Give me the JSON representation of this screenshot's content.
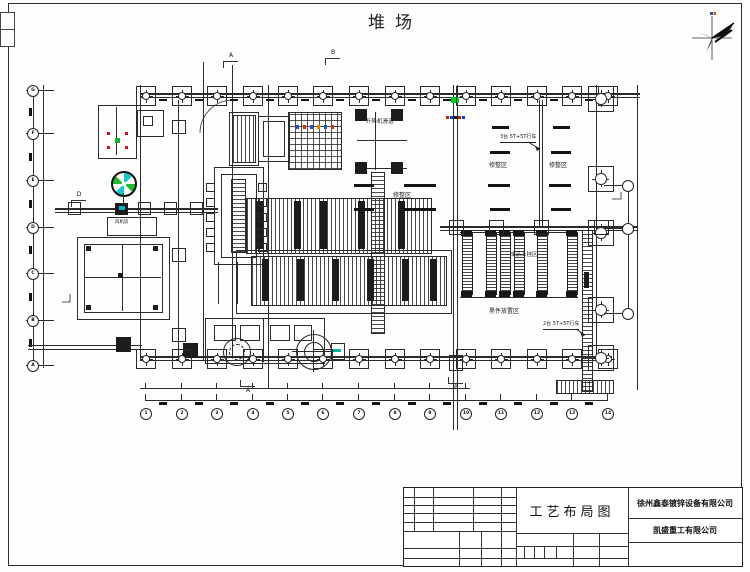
{
  "page": {
    "title": "堆场"
  },
  "titleblock": {
    "drawing_name": "工艺布局图",
    "company1": "徐州鑫泰镀锌设备有限公司",
    "company2": "凯盛重工有限公司"
  },
  "labels": [
    {
      "text": "升降机滑道",
      "x": 366,
      "y": 119,
      "fs": 5.5,
      "u": false
    },
    {
      "text": "修整区",
      "x": 393,
      "y": 193,
      "fs": 6,
      "u": false
    },
    {
      "text": "修整区",
      "x": 489,
      "y": 163,
      "fs": 6,
      "u": false
    },
    {
      "text": "修整区",
      "x": 549,
      "y": 163,
      "fs": 6,
      "u": false
    },
    {
      "text": "3台 5T+5T行车",
      "x": 500,
      "y": 135,
      "fs": 5,
      "u": true
    },
    {
      "text": "2台 5T+5T行车",
      "x": 543,
      "y": 322,
      "fs": 5,
      "u": true
    },
    {
      "text": "成品上挂区",
      "x": 510,
      "y": 252,
      "fs": 5.5,
      "u": false
    },
    {
      "text": "黑件放置区",
      "x": 489,
      "y": 309,
      "fs": 6,
      "u": false
    },
    {
      "text": "风机房",
      "x": 115,
      "y": 221,
      "fs": 4.5,
      "u": false
    }
  ],
  "sections": [
    {
      "t": "A",
      "x": 224,
      "y": 52,
      "d": 1
    },
    {
      "t": "B",
      "x": 326,
      "y": 49,
      "d": 1
    },
    {
      "t": "A",
      "x": 241,
      "y": 386,
      "d": 0
    },
    {
      "t": "B",
      "x": 449,
      "y": 383,
      "d": 0
    },
    {
      "t": "D",
      "x": 72,
      "y": 191,
      "d": 1
    }
  ],
  "grid": {
    "bottom_labels": [
      "1",
      "2",
      "3",
      "4",
      "5",
      "6",
      "7",
      "8",
      "9",
      "10",
      "11",
      "12",
      "13",
      "14"
    ],
    "left_labels": [
      "G",
      "F",
      "E",
      "D",
      "C",
      "B",
      "A"
    ]
  },
  "structure": {
    "col_xs": [
      145,
      181,
      216,
      252,
      287,
      322,
      358,
      394,
      429,
      465,
      500,
      536,
      571,
      607
    ],
    "left_ys": [
      90,
      133,
      180,
      227,
      273,
      320,
      365
    ],
    "right_sq_ys": [
      86,
      166,
      220,
      297,
      345
    ],
    "right_bub_ys": [
      185,
      228,
      313
    ],
    "rack_xs": [
      462,
      486,
      500,
      514,
      537,
      567
    ],
    "tank_bars": [
      [
        256,
        201,
        48
      ],
      [
        294,
        201,
        48
      ],
      [
        320,
        201,
        48
      ],
      [
        358,
        201,
        48
      ],
      [
        398,
        201,
        48
      ],
      [
        262,
        259,
        42
      ],
      [
        297,
        259,
        42
      ],
      [
        332,
        259,
        42
      ],
      [
        367,
        259,
        42
      ],
      [
        402,
        259,
        42
      ],
      [
        430,
        259,
        42
      ]
    ],
    "dashes": [
      [
        492,
        126,
        17
      ],
      [
        553,
        126,
        17
      ],
      [
        490,
        151,
        20
      ],
      [
        551,
        151,
        20
      ],
      [
        488,
        184,
        22
      ],
      [
        549,
        184,
        22
      ],
      [
        490,
        208,
        20
      ],
      [
        551,
        208,
        20
      ],
      [
        354,
        184,
        20
      ],
      [
        404,
        184,
        32
      ],
      [
        354,
        208,
        20
      ],
      [
        404,
        208,
        32
      ]
    ],
    "elev_sq": [
      [
        355,
        109
      ],
      [
        391,
        109
      ],
      [
        355,
        162
      ],
      [
        391,
        162
      ]
    ],
    "wall_sq_xs": [
      455,
      495,
      540,
      600
    ],
    "conv_sq_xs": [
      68,
      138,
      164,
      190
    ],
    "kettle_tick_xs": [
      206,
      258
    ],
    "kettle_tick_ys": [
      183,
      198,
      213,
      228,
      243
    ],
    "rail_block_ys": [
      120,
      248,
      328
    ],
    "room_dots": [
      [
        86,
        246
      ],
      [
        153,
        246
      ],
      [
        86,
        305
      ],
      [
        153,
        305
      ],
      [
        118,
        273
      ]
    ],
    "lines": [
      [
        140,
        93,
        500,
        2
      ],
      [
        140,
        97,
        500,
        1
      ],
      [
        140,
        356,
        472,
        2
      ],
      [
        140,
        360,
        472,
        1
      ],
      [
        440,
        226,
        197,
        2
      ],
      [
        440,
        230,
        197,
        1
      ],
      [
        637,
        85,
        1,
        305
      ],
      [
        140,
        85,
        1,
        275
      ],
      [
        596,
        85,
        1,
        272
      ],
      [
        178,
        100,
        1,
        256
      ],
      [
        203,
        62,
        1,
        298
      ],
      [
        232,
        65,
        1,
        293
      ],
      [
        268,
        85,
        1,
        303
      ],
      [
        453,
        85,
        1,
        345
      ],
      [
        457,
        85,
        1,
        345
      ],
      [
        539,
        100,
        1,
        128
      ],
      [
        542,
        100,
        1,
        128
      ],
      [
        55,
        208,
        163,
        2
      ],
      [
        55,
        212,
        163,
        1
      ],
      [
        28,
        345,
        114,
        1
      ],
      [
        28,
        349,
        114,
        1
      ],
      [
        140,
        388,
        330,
        1
      ],
      [
        145,
        400,
        462,
        1
      ],
      [
        33,
        88,
        1,
        277
      ],
      [
        43,
        85,
        1,
        283
      ],
      [
        628,
        180,
        1,
        140
      ],
      [
        218,
        262,
        1,
        42
      ],
      [
        237,
        262,
        1,
        42
      ],
      [
        375,
        112,
        1,
        58
      ],
      [
        357,
        140,
        50,
        1
      ],
      [
        357,
        168,
        50,
        1
      ],
      [
        460,
        232,
        118,
        1
      ],
      [
        460,
        297,
        118,
        1
      ],
      [
        116,
        107,
        1,
        48
      ],
      [
        122,
        244,
        1,
        67
      ],
      [
        84,
        277,
        77,
        1
      ],
      [
        263,
        318,
        1,
        44
      ],
      [
        313,
        330,
        1,
        42
      ],
      [
        292,
        351,
        42,
        1
      ],
      [
        123,
        193,
        1,
        14
      ]
    ],
    "boxes": [
      [
        98,
        105,
        37,
        52
      ],
      [
        137,
        110,
        25,
        25
      ],
      [
        143,
        116,
        8,
        8
      ],
      [
        107,
        217,
        48,
        17
      ],
      [
        77,
        237,
        91,
        81
      ],
      [
        84,
        244,
        77,
        67
      ],
      [
        214,
        167,
        48,
        96
      ],
      [
        221,
        174,
        34,
        82
      ],
      [
        229,
        112,
        28,
        52
      ],
      [
        258,
        116,
        30,
        44
      ],
      [
        263,
        121,
        20,
        34
      ],
      [
        236,
        250,
        214,
        62
      ],
      [
        205,
        318,
        118,
        44
      ],
      [
        214,
        325,
        20,
        14
      ],
      [
        240,
        325,
        18,
        14
      ],
      [
        270,
        325,
        18,
        14
      ],
      [
        294,
        325,
        16,
        14
      ],
      [
        331,
        343,
        12,
        15
      ],
      [
        449,
        355,
        12,
        14
      ]
    ],
    "hatches": [
      [
        "hv",
        232,
        115,
        22,
        46
      ],
      [
        "grid",
        288,
        112,
        52,
        56
      ],
      [
        "hv",
        246,
        198,
        184,
        54
      ],
      [
        "hv",
        251,
        256,
        194,
        48
      ],
      [
        "hh",
        231,
        179,
        13,
        72
      ],
      [
        "hh",
        371,
        172,
        12,
        160
      ],
      [
        "hh",
        582,
        230,
        9,
        160
      ],
      [
        "hv",
        556,
        380,
        56,
        12
      ]
    ],
    "fills": [
      [
        115,
        203,
        13,
        12
      ],
      [
        183,
        343,
        15,
        15
      ],
      [
        584,
        272,
        5,
        16
      ],
      [
        116,
        337,
        15,
        15
      ]
    ],
    "specks": [
      [
        451,
        97,
        8,
        6,
        "#00cc22"
      ],
      [
        446,
        116,
        3,
        3,
        "#cc2200"
      ],
      [
        450,
        116,
        3,
        3,
        "#0044cc"
      ],
      [
        454,
        116,
        3,
        3,
        "#111111"
      ],
      [
        458,
        116,
        3,
        3,
        "#cc2200"
      ],
      [
        462,
        116,
        3,
        3,
        "#0044cc"
      ],
      [
        296,
        125,
        3,
        4,
        "#2255cc"
      ],
      [
        303,
        125,
        3,
        4,
        "#cc3311"
      ],
      [
        310,
        125,
        3,
        4,
        "#2255cc"
      ],
      [
        317,
        125,
        3,
        4,
        "#dd8800"
      ],
      [
        324,
        125,
        3,
        4,
        "#2255cc"
      ],
      [
        331,
        125,
        3,
        4,
        "#cc3311"
      ],
      [
        333,
        349,
        8,
        3,
        "#00b3a3"
      ],
      [
        119,
        206,
        6,
        4,
        "#00b3c8"
      ],
      [
        107,
        132,
        3,
        3,
        "#cc1122"
      ],
      [
        125,
        132,
        3,
        3,
        "#cc1122"
      ],
      [
        107,
        146,
        3,
        3,
        "#cc1122"
      ],
      [
        125,
        146,
        3,
        3,
        "#cc1122"
      ],
      [
        115,
        138,
        5,
        5,
        "#18b030"
      ]
    ]
  }
}
